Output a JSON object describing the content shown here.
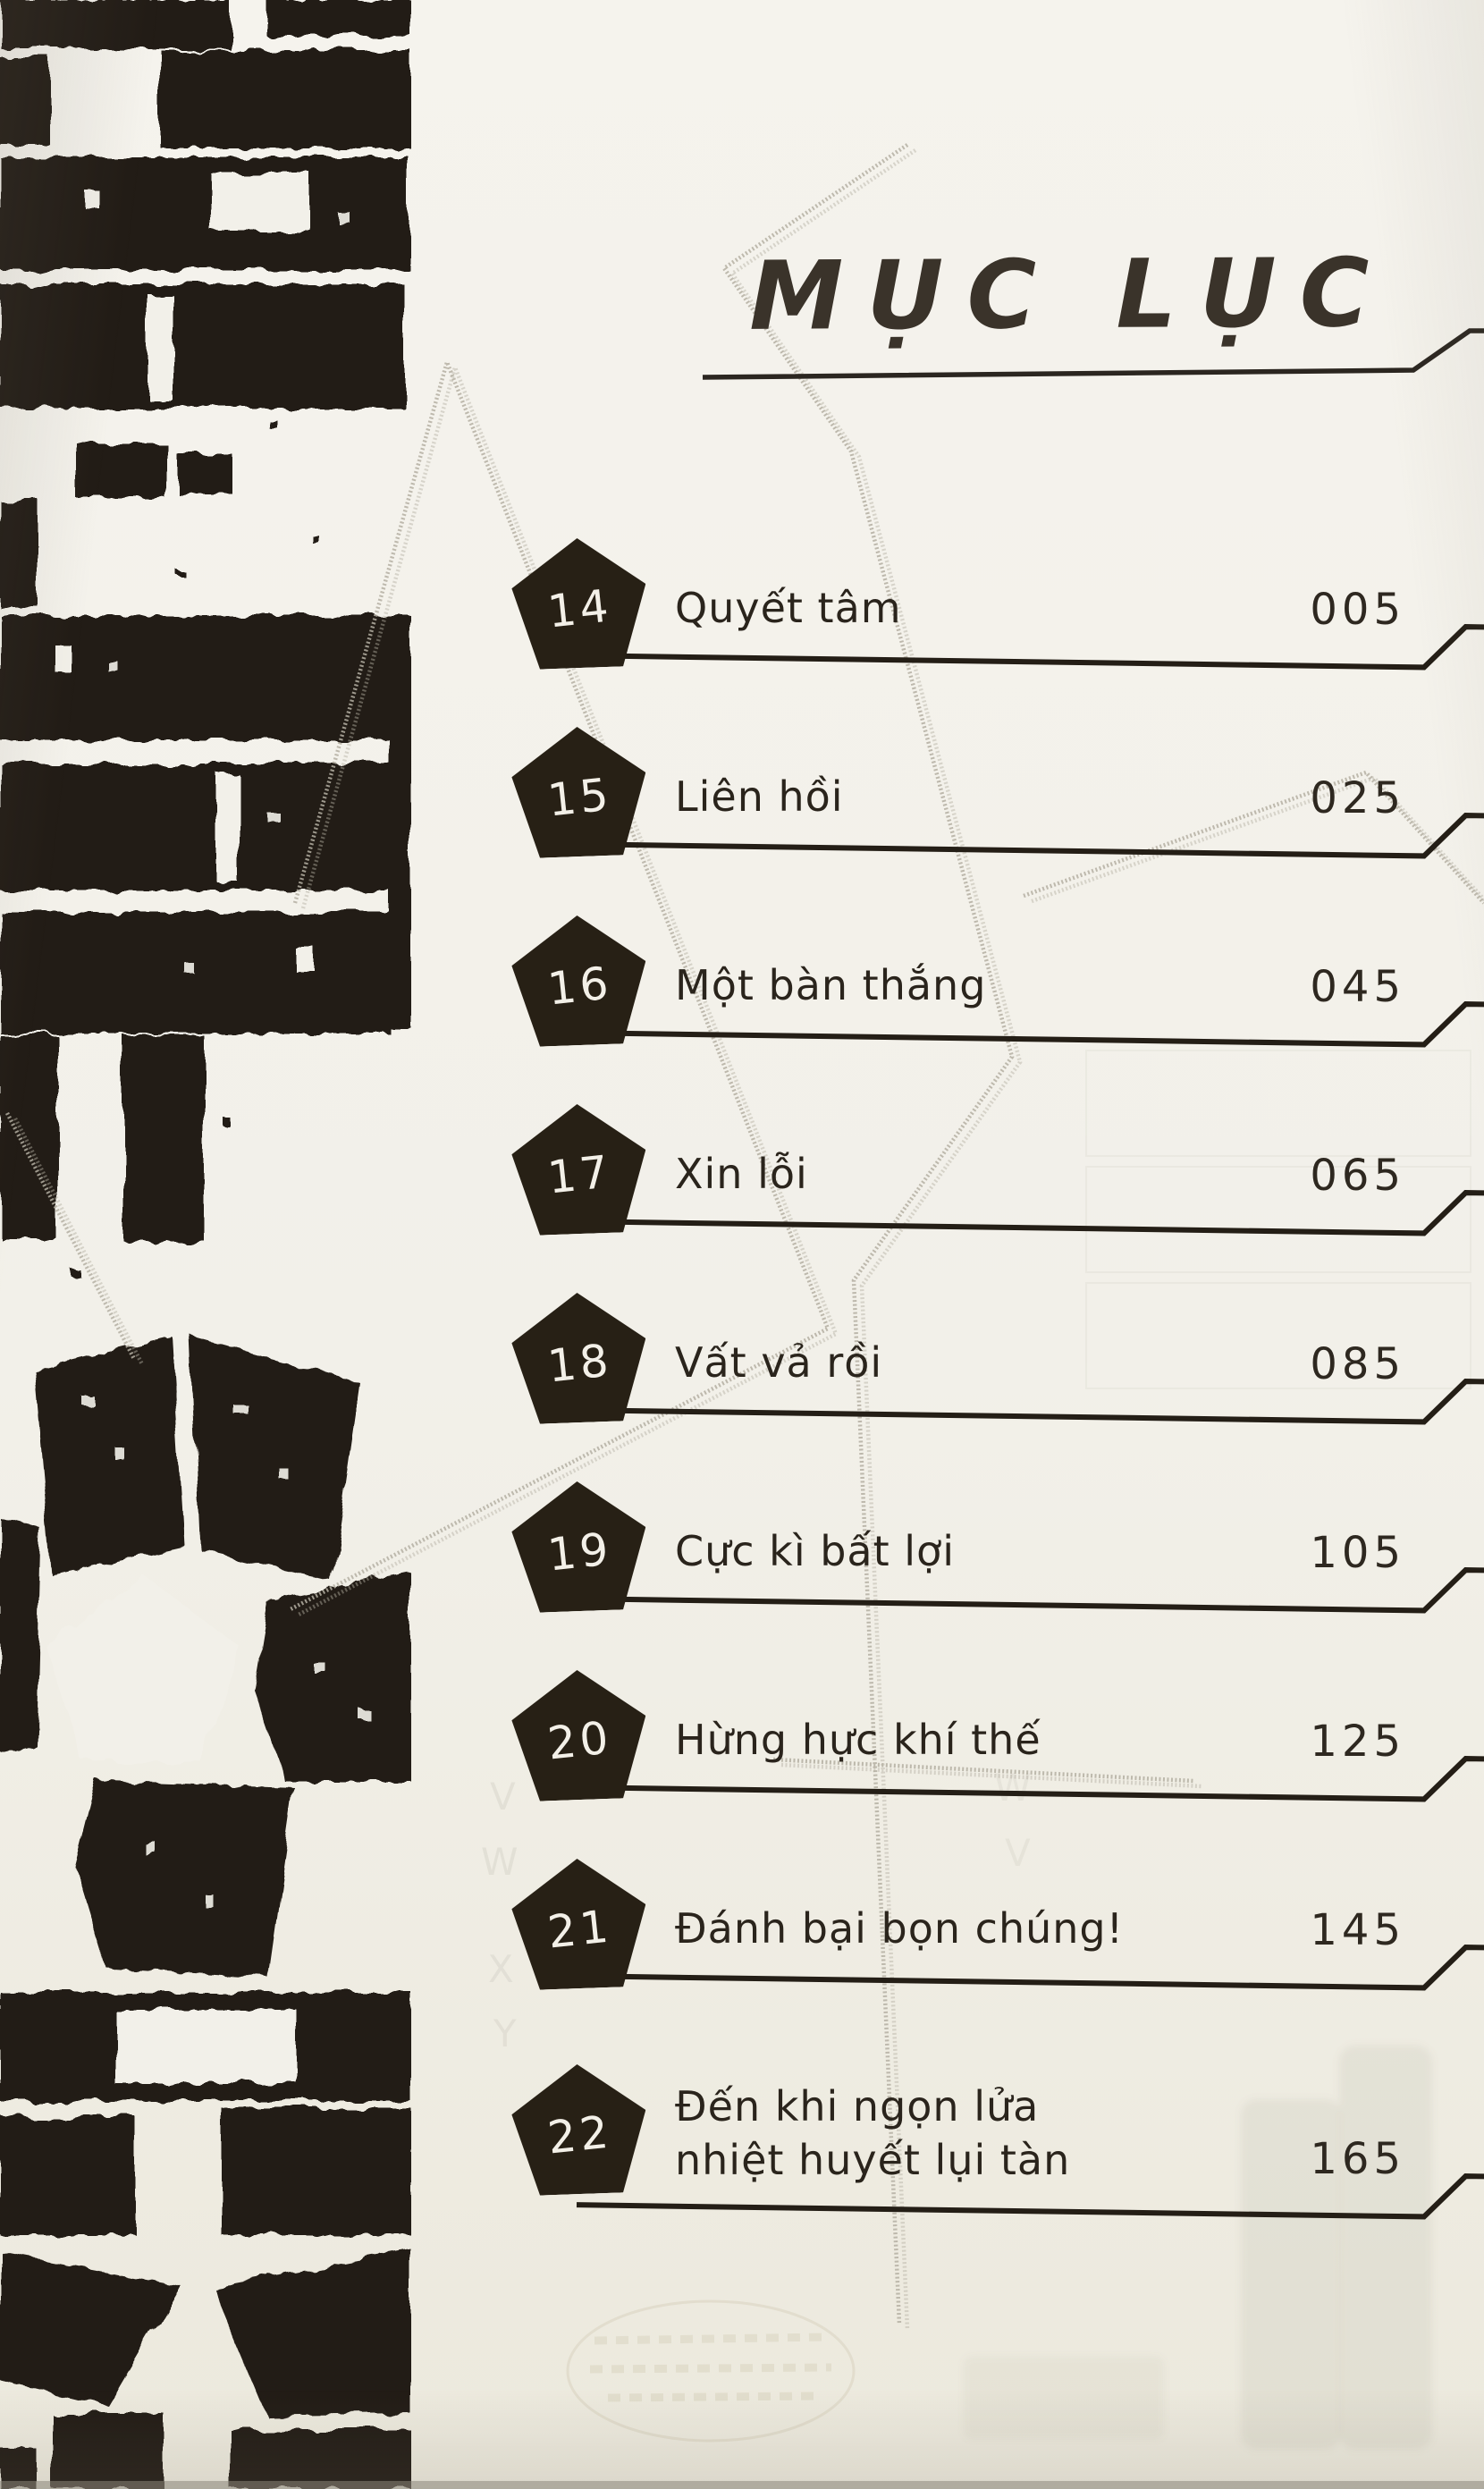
{
  "page": {
    "title": "MỤC LỤC",
    "colors": {
      "ink": "#241e16",
      "paper": "#f2f0e9",
      "badge": "#272015",
      "watermark": "#b4afa2"
    }
  },
  "toc": {
    "entries": [
      {
        "number": "14",
        "title_lines": [
          "Quyết tâm"
        ],
        "page": "005"
      },
      {
        "number": "15",
        "title_lines": [
          "Liên hồi"
        ],
        "page": "025"
      },
      {
        "number": "16",
        "title_lines": [
          "Một bàn thắng"
        ],
        "page": "045"
      },
      {
        "number": "17",
        "title_lines": [
          "Xin lỗi"
        ],
        "page": "065"
      },
      {
        "number": "18",
        "title_lines": [
          "Vất vả rồi"
        ],
        "page": "085"
      },
      {
        "number": "19",
        "title_lines": [
          "Cực kì bất lợi"
        ],
        "page": "105"
      },
      {
        "number": "20",
        "title_lines": [
          "Hừng hực khí thế"
        ],
        "page": "125"
      },
      {
        "number": "21",
        "title_lines": [
          "Đánh bại bọn chúng!"
        ],
        "page": "145"
      },
      {
        "number": "22",
        "title_lines": [
          "Đến khi ngọn lửa",
          "nhiệt huyết lụi tàn"
        ],
        "page": "165"
      }
    ]
  },
  "ghost": {
    "letters_left": [
      "V",
      "W",
      "X",
      "Y"
    ],
    "letters_right": [
      "W",
      "V"
    ]
  }
}
